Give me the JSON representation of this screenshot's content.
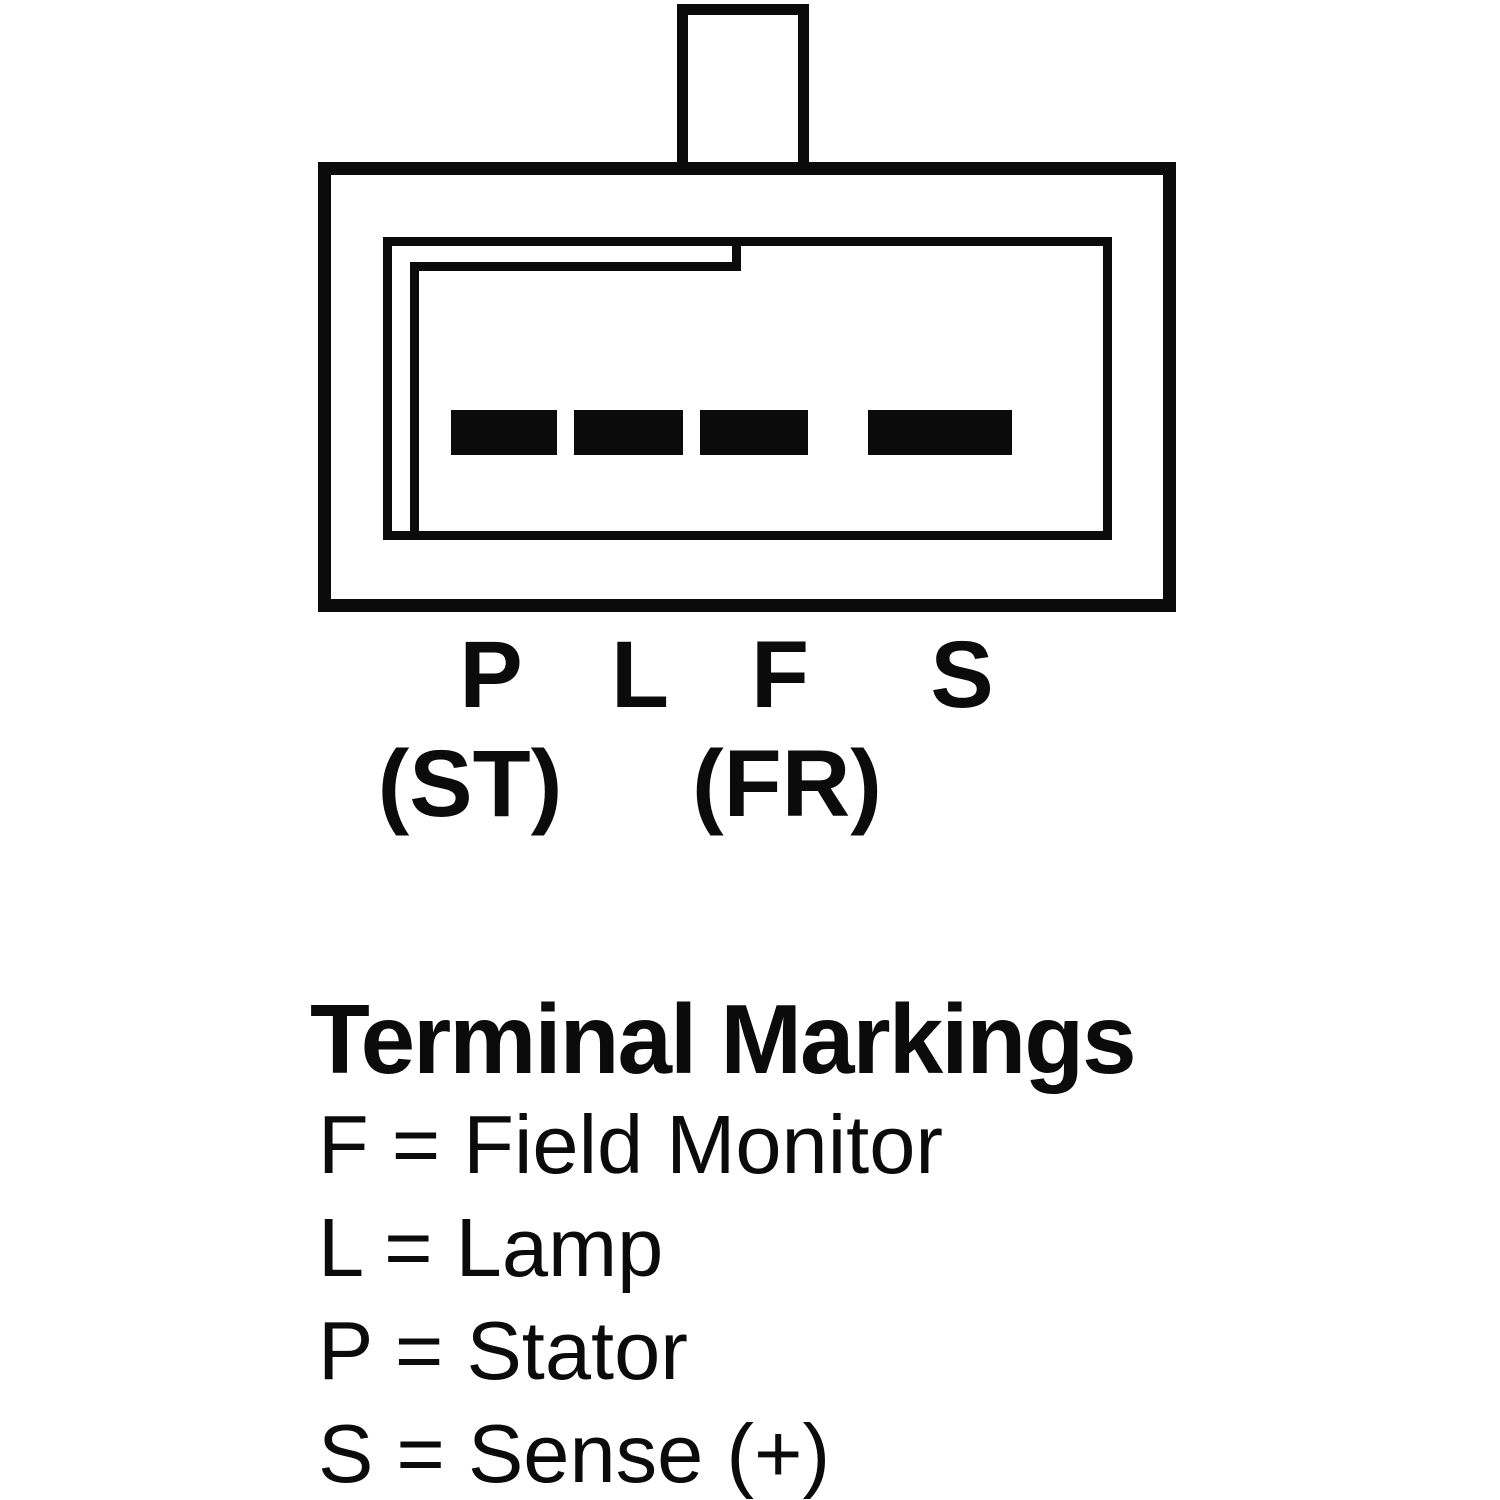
{
  "connector": {
    "terminal_slots": 4,
    "pin_labels": [
      "P",
      "L",
      "F",
      "S"
    ],
    "alt_labels": [
      "(ST)",
      "(FR)"
    ]
  },
  "legend": {
    "title": "Terminal Markings",
    "entries": [
      "F = Field Monitor",
      "L = Lamp",
      "P = Stator",
      "S = Sense (+)"
    ]
  },
  "colors": {
    "line": "#0b0b0b",
    "background": "#ffffff",
    "terminal_fill": "#0b0b0b"
  }
}
